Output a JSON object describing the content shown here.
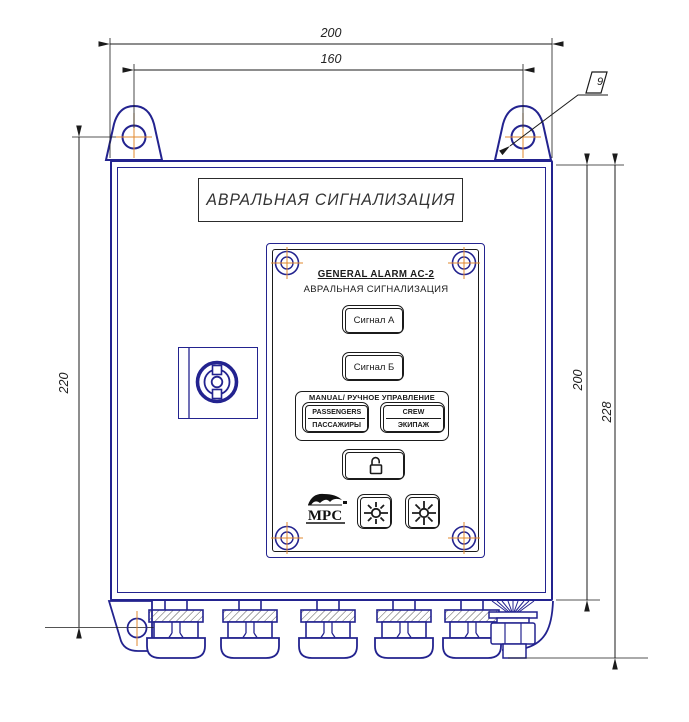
{
  "document": {
    "type": "technical-drawing",
    "title_plate_text": "АВРАЛЬНАЯ СИГНАЛИЗАЦИЯ",
    "callout_flag": "9"
  },
  "panel": {
    "title_en": "GENERAL ALARM AC-2",
    "title_ru": "АВРАЛЬНАЯ  СИГНАЛИЗАЦИЯ",
    "signal_a": "Сигнал А",
    "signal_b": "Сигнал Б",
    "manual_group_label": "MANUAL/ РУЧНОЕ УПРАВЛЕНИЕ",
    "passengers_en": "PASSENGERS",
    "passengers_ru": "ПАССАЖИРЫ",
    "crew_en": "CREW",
    "crew_ru": "ЭКИПАЖ",
    "logo_text": "МРС"
  },
  "dimensions": {
    "top_overall_width": "200",
    "top_hole_spacing": "160",
    "left_hole_spacing": "220",
    "right_body_height": "200",
    "right_overall_height": "228"
  },
  "colors": {
    "outline_blue": "#23238f",
    "line_black": "#1b1b1b",
    "centerline_orange": "#e2882f"
  }
}
